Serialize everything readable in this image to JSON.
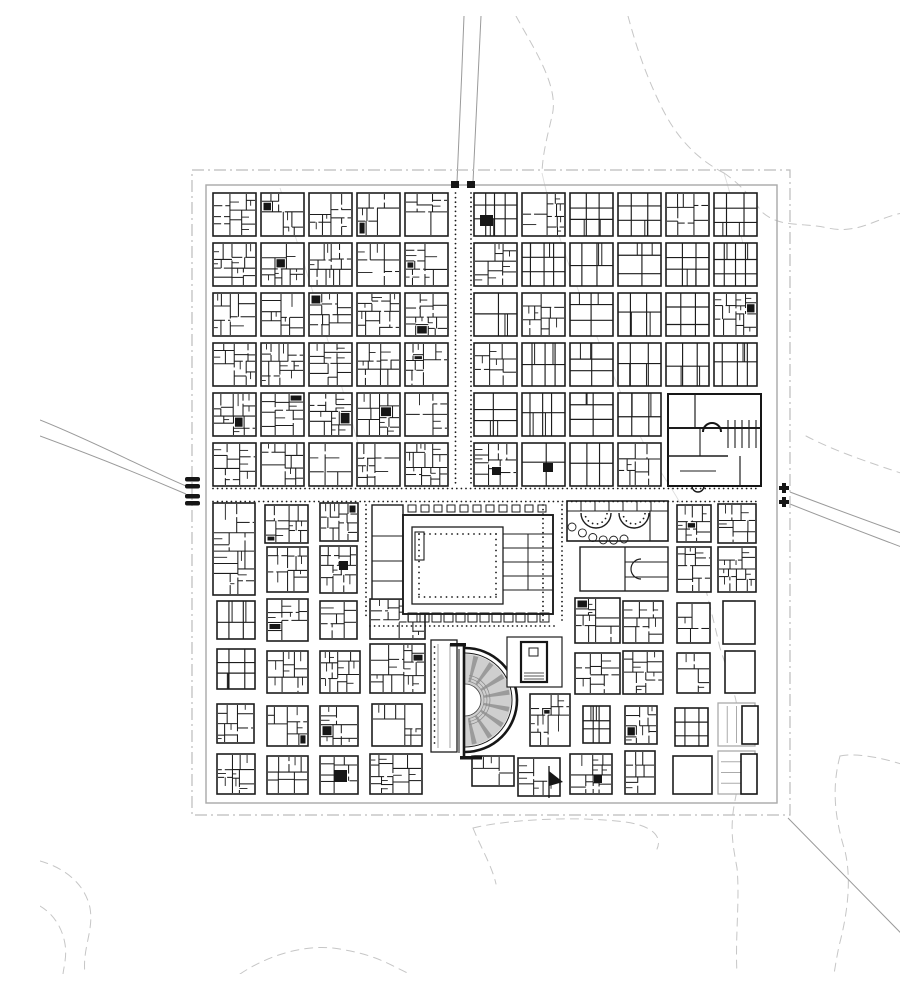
{
  "map_data": {
    "type": "city-plan",
    "canvas": {
      "width": 900,
      "height": 958,
      "background": "#ffffff"
    },
    "palette": {
      "ink": "#161616",
      "block_line": "#1d1d1d",
      "ghost": "#ababab",
      "boundary": "#bcbcbc",
      "wall": "#a9a9a9",
      "road": "#9a9a9a",
      "contour": "#c6c6c6",
      "faint": "#dedede",
      "cavea_fill": "#cfcfcf",
      "cavea_wedge": "#9b9b9b",
      "dot": "#1a1a1a",
      "white": "#ffffff"
    },
    "seed": 1337,
    "boundary": {
      "dashdot": [
        152,
        154,
        598,
        645
      ],
      "wall": [
        166,
        169,
        571,
        618
      ]
    },
    "north_grid": {
      "col_x": [
        173,
        221,
        269,
        317,
        365,
        434,
        482,
        530,
        578,
        626,
        674
      ],
      "row_y": [
        177,
        227,
        277,
        327,
        377,
        427
      ],
      "block_w": 43,
      "block_h": 43,
      "skip_cells": [
        [
          9,
          4
        ],
        [
          10,
          4
        ],
        [
          9,
          5
        ],
        [
          10,
          5
        ]
      ]
    },
    "south_blocks": [
      {
        "x": 173,
        "y": 487,
        "w": 42,
        "h": 92,
        "style": "dense"
      },
      {
        "x": 225,
        "y": 489,
        "w": 43,
        "h": 38,
        "style": "dense"
      },
      {
        "x": 227,
        "y": 531,
        "w": 41,
        "h": 45,
        "style": "dense"
      },
      {
        "x": 280,
        "y": 487,
        "w": 38,
        "h": 38,
        "style": "dense"
      },
      {
        "x": 280,
        "y": 530,
        "w": 37,
        "h": 47,
        "style": "dense"
      },
      {
        "x": 177,
        "y": 585,
        "w": 38,
        "h": 38,
        "style": "simple"
      },
      {
        "x": 227,
        "y": 583,
        "w": 41,
        "h": 42,
        "style": "dense"
      },
      {
        "x": 280,
        "y": 585,
        "w": 37,
        "h": 38,
        "style": "dense"
      },
      {
        "x": 330,
        "y": 583,
        "w": 55,
        "h": 40,
        "style": "dense"
      },
      {
        "x": 177,
        "y": 633,
        "w": 38,
        "h": 40,
        "style": "simple"
      },
      {
        "x": 227,
        "y": 635,
        "w": 41,
        "h": 42,
        "style": "dense"
      },
      {
        "x": 280,
        "y": 635,
        "w": 40,
        "h": 42,
        "style": "dense"
      },
      {
        "x": 330,
        "y": 628,
        "w": 55,
        "h": 49,
        "style": "dense"
      },
      {
        "x": 177,
        "y": 688,
        "w": 37,
        "h": 39,
        "style": "dense"
      },
      {
        "x": 227,
        "y": 690,
        "w": 41,
        "h": 40,
        "style": "dense"
      },
      {
        "x": 280,
        "y": 690,
        "w": 38,
        "h": 40,
        "style": "dense"
      },
      {
        "x": 332,
        "y": 688,
        "w": 50,
        "h": 42,
        "style": "dense"
      },
      {
        "x": 177,
        "y": 738,
        "w": 38,
        "h": 40,
        "style": "dense"
      },
      {
        "x": 227,
        "y": 740,
        "w": 41,
        "h": 38,
        "style": "dense"
      },
      {
        "x": 280,
        "y": 740,
        "w": 38,
        "h": 38,
        "style": "dense"
      },
      {
        "x": 330,
        "y": 738,
        "w": 52,
        "h": 40,
        "style": "dense"
      },
      {
        "x": 637,
        "y": 489,
        "w": 34,
        "h": 37,
        "style": "dense"
      },
      {
        "x": 678,
        "y": 488,
        "w": 38,
        "h": 39,
        "style": "dense"
      },
      {
        "x": 637,
        "y": 531,
        "w": 34,
        "h": 45,
        "style": "dense"
      },
      {
        "x": 678,
        "y": 531,
        "w": 38,
        "h": 45,
        "style": "dense"
      },
      {
        "x": 535,
        "y": 582,
        "w": 45,
        "h": 45,
        "style": "dense"
      },
      {
        "x": 583,
        "y": 585,
        "w": 40,
        "h": 42,
        "style": "dense"
      },
      {
        "x": 637,
        "y": 587,
        "w": 33,
        "h": 40,
        "style": "dense"
      },
      {
        "x": 683,
        "y": 585,
        "w": 32,
        "h": 43,
        "style": "open"
      },
      {
        "x": 535,
        "y": 637,
        "w": 45,
        "h": 41,
        "style": "dense"
      },
      {
        "x": 583,
        "y": 635,
        "w": 40,
        "h": 43,
        "style": "dense"
      },
      {
        "x": 637,
        "y": 637,
        "w": 33,
        "h": 40,
        "style": "dense"
      },
      {
        "x": 685,
        "y": 635,
        "w": 30,
        "h": 42,
        "style": "open"
      },
      {
        "x": 543,
        "y": 690,
        "w": 27,
        "h": 37,
        "style": "simple"
      },
      {
        "x": 585,
        "y": 690,
        "w": 32,
        "h": 38,
        "style": "dense"
      },
      {
        "x": 635,
        "y": 692,
        "w": 33,
        "h": 38,
        "style": "simple"
      },
      {
        "x": 530,
        "y": 738,
        "w": 42,
        "h": 40,
        "style": "dense"
      },
      {
        "x": 585,
        "y": 735,
        "w": 30,
        "h": 43,
        "style": "dense"
      },
      {
        "x": 633,
        "y": 740,
        "w": 39,
        "h": 38,
        "style": "open"
      },
      {
        "x": 490,
        "y": 678,
        "w": 40,
        "h": 52,
        "style": "dense"
      },
      {
        "x": 432,
        "y": 740,
        "w": 42,
        "h": 30,
        "style": "dense"
      },
      {
        "x": 478,
        "y": 742,
        "w": 42,
        "h": 38,
        "style": "dense"
      }
    ],
    "ghost_blocks": [
      {
        "x": 678,
        "y": 687,
        "w": 37,
        "h": 43,
        "lines": "v",
        "black": [
          702,
          690,
          16,
          38
        ]
      },
      {
        "x": 678,
        "y": 735,
        "w": 37,
        "h": 43,
        "lines": "h",
        "black": [
          701,
          738,
          16,
          40
        ]
      }
    ],
    "black_rooms": [
      [
        440,
        199,
        13,
        11
      ],
      [
        452,
        451,
        9,
        8
      ],
      [
        503,
        447,
        10,
        9
      ],
      [
        299,
        545,
        9,
        9
      ],
      [
        294,
        754,
        13,
        12
      ],
      [
        554,
        759,
        8,
        8
      ]
    ],
    "landmarks": {
      "forum": {
        "name": "forum",
        "annex": [
          332,
          489,
          31,
          94
        ],
        "outer": [
          363,
          499,
          150,
          99
        ],
        "court": [
          372,
          511,
          91,
          77
        ],
        "temple": [
          375,
          516,
          9,
          28
        ],
        "dots_inset": 7,
        "dots_step": 5.5,
        "east_room_x": [
          463,
          513
        ],
        "east_vline": 488,
        "east_hlines": [
          518,
          532,
          546,
          560,
          574
        ],
        "portico_y": 489,
        "shops_y": 597
      },
      "theater": {
        "name": "theater",
        "cx": 425,
        "cy": 684,
        "r_outer": 52,
        "r_outer2": 47,
        "r_cavea": 46,
        "r_orchestra": 16,
        "wedge_angles": [
          -76,
          -54,
          -32,
          -10,
          12,
          34,
          56,
          78
        ],
        "seat_radii": [
          19,
          22,
          25
        ],
        "chord_x": 424,
        "chord_y1": 630,
        "chord_y2": 740
      },
      "market": {
        "name": "market",
        "outer": [
          527,
          485,
          101,
          40
        ],
        "exedra": [
          [
            556,
            497,
            15
          ],
          [
            594,
            497,
            15
          ]
        ],
        "scallop_from": [
          532,
          511
        ],
        "scallop_to": [
          584,
          523
        ],
        "scallop_n": 6
      },
      "library": {
        "name": "library",
        "outer": [
          540,
          531,
          88,
          44
        ],
        "vline": 585,
        "apse": [
          601,
          553,
          10
        ]
      },
      "baths": {
        "name": "baths",
        "outer": [
          628,
          378,
          93,
          92
        ],
        "apse": [
          672,
          416,
          9
        ],
        "pool_x": [
          688,
          718
        ],
        "pool_y": [
          404,
          432
        ]
      },
      "temple": {
        "name": "temple-enclosure",
        "outer": [
          467,
          621,
          55,
          50
        ],
        "cella": [
          481,
          626,
          26,
          40
        ],
        "altar": [
          489,
          632,
          9,
          8
        ]
      },
      "portico": {
        "name": "portico-building",
        "outer": [
          391,
          624,
          26,
          112
        ]
      }
    },
    "gates": {
      "north_squares": [
        [
          411,
          165,
          8,
          7
        ],
        [
          427,
          165,
          8,
          7
        ]
      ],
      "west_bars": [
        [
          145,
          461,
          15,
          4.5
        ],
        [
          145,
          468,
          15,
          4.5
        ],
        [
          145,
          478,
          15,
          4.5
        ],
        [
          145,
          485,
          15,
          4.5
        ]
      ],
      "east_crosses": [
        [
          744,
          472
        ],
        [
          744,
          486
        ]
      ],
      "flag": {
        "pole": [
          509,
          750,
          509,
          782
        ],
        "tri": [
          [
            509,
            755
          ],
          [
            523,
            766
          ],
          [
            509,
            770
          ]
        ]
      }
    },
    "roads": [
      "M424,0 C422,55 419,120 417,166",
      "M441,0 C438,60 435,120 433,166",
      "M0,404 C55,426 112,456 146,470",
      "M0,420 C65,444 118,466 146,478",
      "M750,476 C800,495 855,515 900,531",
      "M750,488 C810,512 860,530 900,546",
      "M748,802 L900,957"
    ],
    "contours": [
      "M476,0 C492,30 520,70 512,100 C508,118 503,135 502,156",
      "M588,0 C596,30 606,60 622,92 C636,120 655,142 684,157",
      "M684,157 C700,168 710,180 722,196 C740,212 760,206 788,212 C820,219 838,200 868,196 C884,194 894,198 900,199",
      "M766,420 C800,438 846,452 900,470",
      "M646,490 C658,545 668,580 680,632 C692,668 700,690 701,726 C702,752 698,768 694,790 C690,815 693,830 697,852 C700,885 695,920 697,958",
      "M800,740 C792,770 794,800 805,835 C812,865 807,900 799,930 C796,945 795,952 794,958",
      "M800,740 C820,736 850,744 874,752 C886,757 895,762 900,766",
      "M433,812 C470,803 540,800 585,806 C615,810 622,822 617,833",
      "M433,812 C441,832 452,850 456,868",
      "M200,958 C230,938 270,926 305,934 C340,940 355,952 370,958",
      "M0,845 C25,852 45,868 50,892 C54,915 42,932 45,958",
      "M0,890 C12,897 22,910 25,928 C27,940 24,950 23,958"
    ],
    "faint_lines": [
      "M502,157 C520,240 560,330 600,420 C615,450 630,468 640,487",
      "M240,172 C268,260 300,360 330,470",
      "M684,157 C694,190 700,215 706,240"
    ],
    "dotted_streets": [
      {
        "o": "h",
        "y": 472.5,
        "a": 173,
        "b": 717
      },
      {
        "o": "h",
        "y": 485.5,
        "a": 173,
        "b": 717
      },
      {
        "o": "v",
        "x": 415.5,
        "a": 177,
        "b": 470
      },
      {
        "o": "v",
        "x": 431,
        "a": 177,
        "b": 470
      },
      {
        "o": "v",
        "x": 326,
        "a": 489,
        "b": 600
      },
      {
        "o": "v",
        "x": 503,
        "a": 489,
        "b": 608
      },
      {
        "o": "v",
        "x": 522,
        "a": 489,
        "b": 606
      },
      {
        "o": "h",
        "y": 610,
        "a": 330,
        "b": 515
      }
    ]
  }
}
